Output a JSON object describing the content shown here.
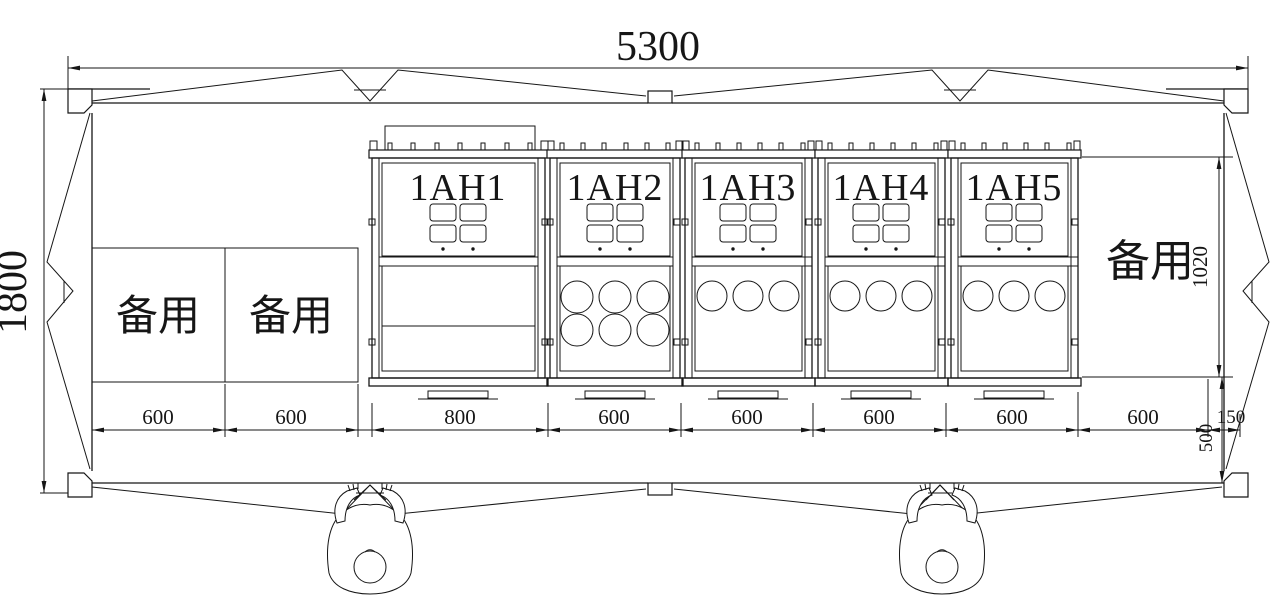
{
  "drawing": {
    "kind": "substation-plan",
    "cabinets": [
      {
        "label": "1AH1"
      },
      {
        "label": "1AH2"
      },
      {
        "label": "1AH3"
      },
      {
        "label": "1AH4"
      },
      {
        "label": "1AH5"
      }
    ],
    "spares": {
      "left1": "备用",
      "left2": "备用",
      "right": "备用"
    },
    "dims": {
      "overall_width": "5300",
      "overall_depth": "1800",
      "bottom": [
        "600",
        "600",
        "800",
        "600",
        "600",
        "600",
        "600",
        "600",
        "150"
      ],
      "cabinet_height": "1020",
      "front_clearance": "500"
    },
    "colors": {
      "line": "#161616",
      "background": "#ffffff"
    }
  }
}
